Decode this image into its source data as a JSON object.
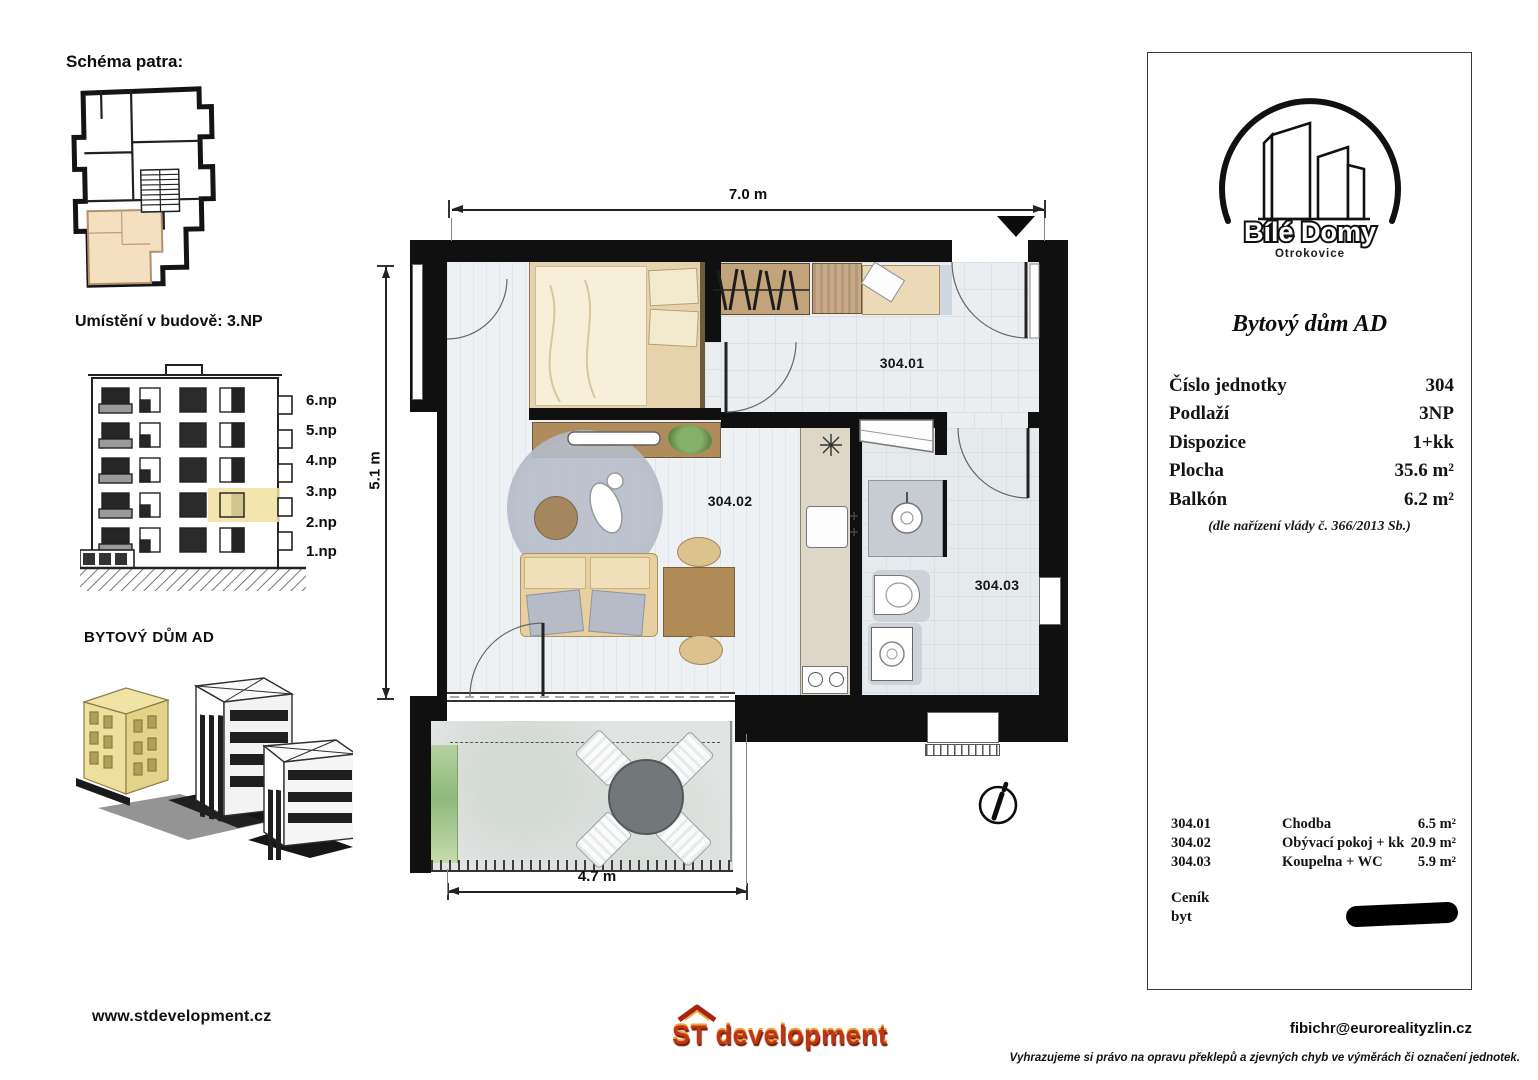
{
  "left_panel": {
    "schema_title": "Schéma patra:",
    "location_title": "Umístění v budově: 3.NP",
    "building_label": "BYTOVÝ DŮM AD",
    "floors": [
      "6.np",
      "5.np",
      "4.np",
      "3.np",
      "2.np",
      "1.np"
    ],
    "website": "www.stdevelopment.cz"
  },
  "plan": {
    "dims": {
      "top": "7.0 m",
      "left": "5.1 m",
      "bottom": "4.7 m"
    },
    "rooms": [
      {
        "id": "304.01"
      },
      {
        "id": "304.02"
      },
      {
        "id": "304.03"
      }
    ],
    "icons": {
      "entry_marker": "filled-triangle-down",
      "north_indicator": "circle-arrow"
    }
  },
  "right_panel": {
    "logo": {
      "name": "Bílé Domy",
      "city": "Otrokovice"
    },
    "title": "Bytový dům AD",
    "details": [
      {
        "label": "Číslo jednotky",
        "value": "304"
      },
      {
        "label": "Podlaží",
        "value": "3NP"
      },
      {
        "label": "Dispozice",
        "value": "1+kk"
      },
      {
        "label": "Plocha",
        "value": "35.6 m²"
      },
      {
        "label": "Balkón",
        "value": "6.2 m²"
      }
    ],
    "regulation": "(dle nařízení vlády č. 366/2013 Sb.)",
    "room_list": [
      {
        "id": "304.01",
        "name": "Chodba",
        "area": "6.5 m²"
      },
      {
        "id": "304.02",
        "name": "Obývací pokoj + kk",
        "area": "20.9 m²"
      },
      {
        "id": "304.03",
        "name": "Koupelna + WC",
        "area": "5.9 m²"
      }
    ],
    "price": {
      "label": "Ceník",
      "sublabel": "byt"
    }
  },
  "footer": {
    "developer_logo": "ST development",
    "email": "fibichr@eurorealityzlin.cz",
    "disclaimer": "Vyhrazujeme si právo na opravu překlepů a zjevných chyb ve výměrách či označení jednotek."
  },
  "colors": {
    "highlight_unit": "#f4dfc0",
    "highlight_floor": "#f1e0a0",
    "logo_red": "#bf3415",
    "redaction": "#000000"
  }
}
